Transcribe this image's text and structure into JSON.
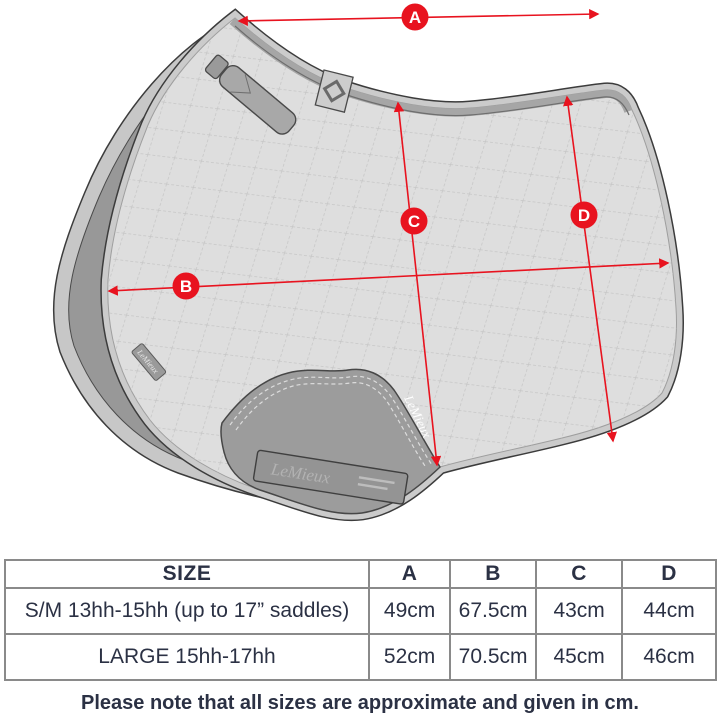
{
  "diagram": {
    "brand": "LeMieux",
    "edge_tag_text": "LeMieux",
    "patch_text": "LeMieux",
    "patch_label_text": "LeMieux",
    "labels": {
      "a": "A",
      "b": "B",
      "c": "C",
      "d": "D"
    }
  },
  "table": {
    "headers": [
      "SIZE",
      "A",
      "B",
      "C",
      "D"
    ],
    "rows": [
      {
        "size": "S/M 13hh-15hh (up to 17” saddles)",
        "a": "49cm",
        "b": "67.5cm",
        "c": "43cm",
        "d": "44cm"
      },
      {
        "size": "LARGE 15hh-17hh",
        "a": "52cm",
        "b": "70.5cm",
        "c": "45cm",
        "d": "46cm"
      }
    ]
  },
  "note": "Please note that all sizes are approximate and given in cm.",
  "colors": {
    "accent_red": "#e8131f",
    "text_navy": "#2b3144",
    "table_border": "#8a8a8a",
    "pad_surface": "#dedede",
    "pad_underside": "#989898"
  }
}
